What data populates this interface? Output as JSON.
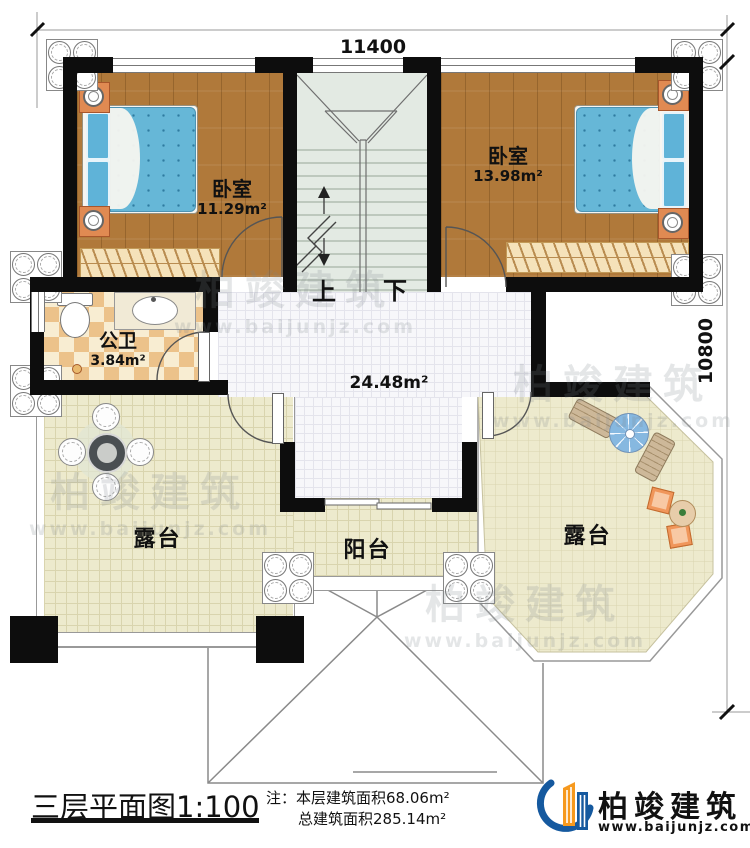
{
  "dimensions": {
    "width_label": "11400",
    "depth_label": "10800"
  },
  "rooms": {
    "bedroom_left": {
      "name": "卧室",
      "area": "11.29m²"
    },
    "bedroom_right": {
      "name": "卧室",
      "area": "13.98m²"
    },
    "bathroom": {
      "name": "公卫",
      "area": "3.84m²"
    },
    "hall": {
      "area": "24.48m²"
    },
    "terrace_left": {
      "name": "露台"
    },
    "terrace_right": {
      "name": "露台"
    },
    "balcony": {
      "name": "阳台"
    },
    "stairs": {
      "up_label": "上",
      "down_label": "下"
    }
  },
  "watermark": {
    "brand": "柏竣建筑",
    "url": "www.baijunjz.com"
  },
  "footer": {
    "title": "三层平面图",
    "scale": "1:100",
    "note_label": "注：",
    "note_line1": "本层建筑面积68.06m²",
    "note_line2": "总建筑面积285.14m²",
    "brand": "柏竣建筑",
    "brand_url": "www.baijunjz.com"
  }
}
